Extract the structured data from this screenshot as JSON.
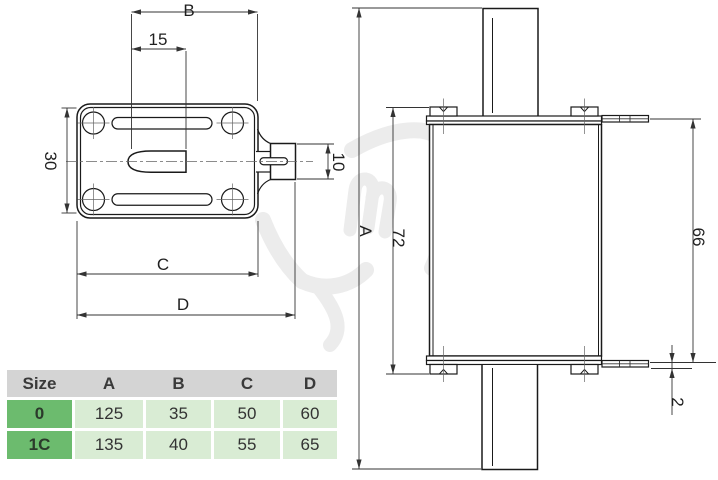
{
  "diagram": {
    "labels": {
      "b": "B",
      "len15": "15",
      "h30": "30",
      "tab10": "10",
      "c": "C",
      "d": "D",
      "a": "A",
      "h72": "72",
      "h66": "66",
      "t2": "2"
    }
  },
  "table": {
    "headers": [
      "Size",
      "A",
      "B",
      "C",
      "D"
    ],
    "rows": [
      {
        "size": "0",
        "values": [
          "125",
          "35",
          "50",
          "60"
        ]
      },
      {
        "size": "1C",
        "values": [
          "135",
          "40",
          "55",
          "65"
        ]
      }
    ]
  },
  "colors": {
    "table_header_bg": "#d4d4d4",
    "size_column_bg": "#6cbb6e",
    "value_cell_bg": "#d9ecd4",
    "drawing_line": "#1a1a1a",
    "watermark": "#ececec"
  }
}
